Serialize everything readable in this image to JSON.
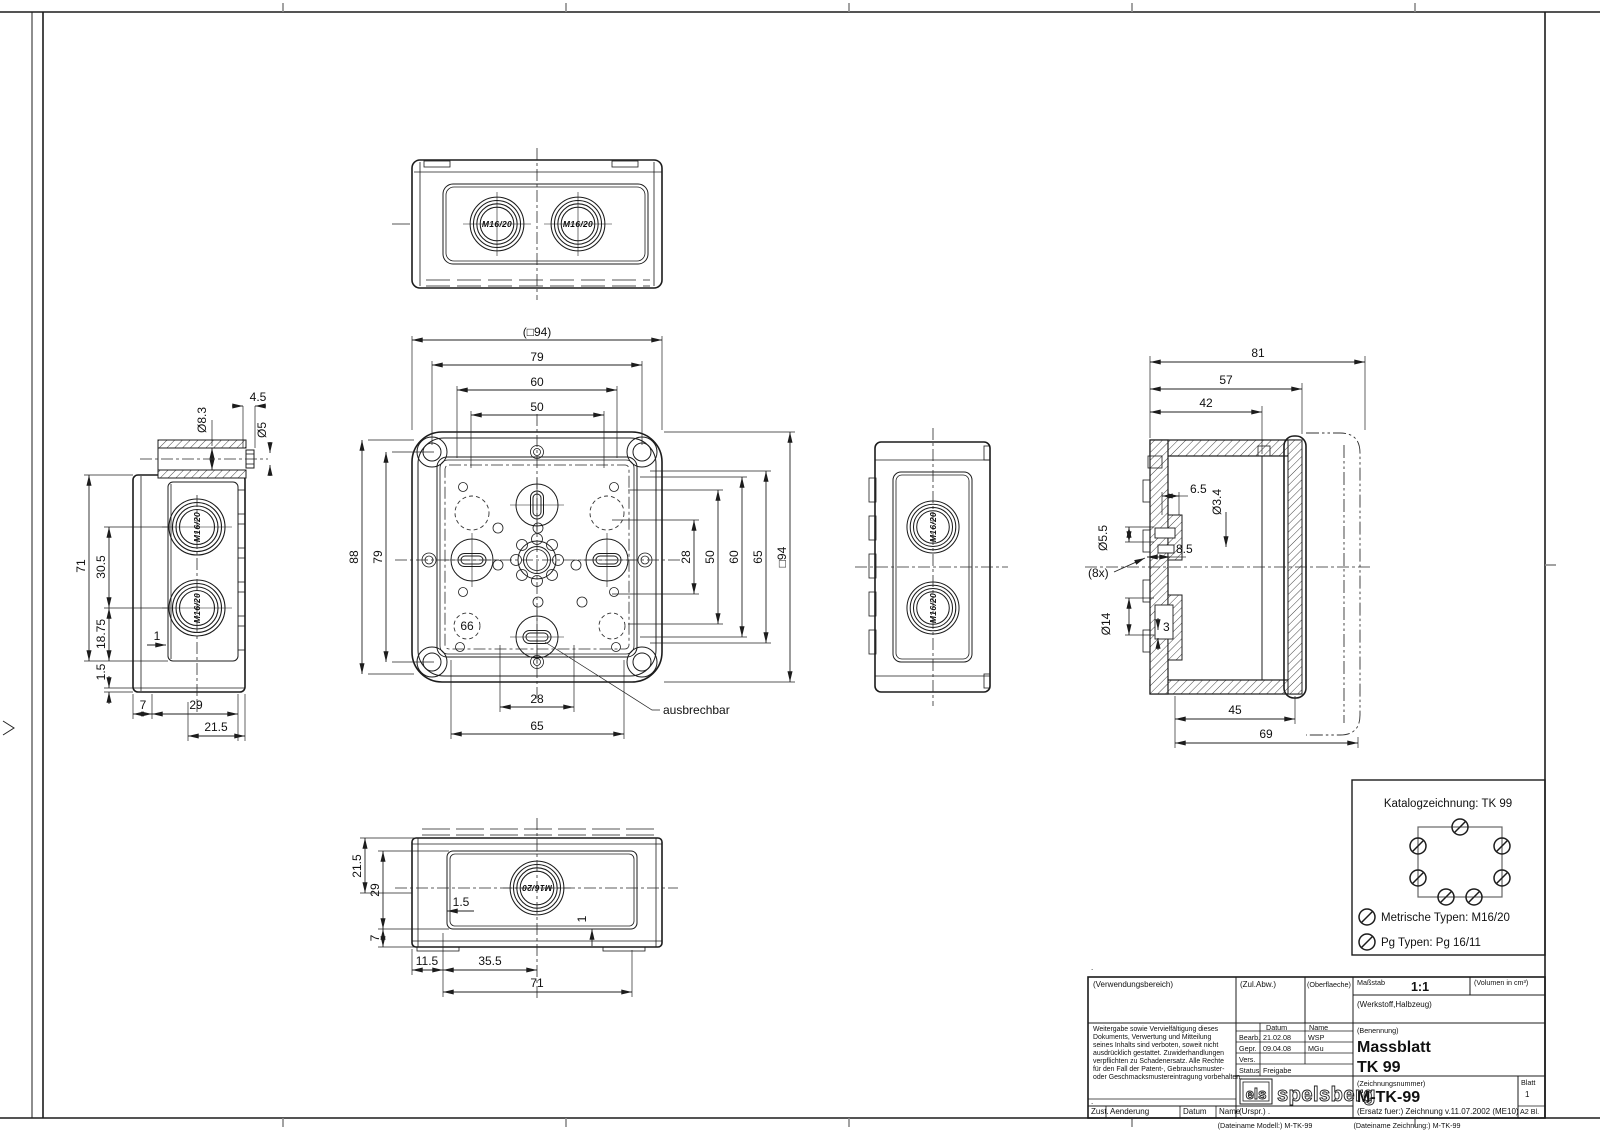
{
  "labels": {
    "m1620": "M16/20",
    "l66": "66",
    "ausbrechbar": "ausbrechbar"
  },
  "dims": {
    "main": {
      "sq94": "(□94)",
      "t79": "79",
      "t60": "60",
      "t50": "50",
      "l88": "88",
      "l79": "79",
      "r28": "28",
      "r50": "50",
      "r60": "60",
      "r65": "65",
      "r94": "□94",
      "b28": "28",
      "b65": "65"
    },
    "left": {
      "dia83": "Ø8.3",
      "d45": "4.5",
      "dia5": "Ø5",
      "d71": "71",
      "d305": "30.5",
      "d1875": "18.75",
      "d15": "1.5",
      "d1": "1",
      "d7": "7",
      "d29": "29",
      "d215": "21.5"
    },
    "section": {
      "d81": "81",
      "d57": "57",
      "d42": "42",
      "d65": "6.5",
      "dia34": "Ø3.4",
      "dia55": "Ø5.5",
      "d85": "8.5",
      "d8x": "(8x)",
      "dia14": "Ø14",
      "d3": "3",
      "d45": "45",
      "d69": "69"
    },
    "bottom": {
      "d215": "21.5",
      "d29": "29",
      "d7": "7",
      "d15": "1.5",
      "d1": "1",
      "d115": "11.5",
      "d355": "35.5",
      "d71": "71"
    }
  },
  "catalog": {
    "title": "Katalogzeichnung: TK 99",
    "metric": "Metrische Typen: M16/20",
    "pg": "Pg Typen: Pg 16/11"
  },
  "titleblock": {
    "verwendungsbereich": "(Verwendungsbereich)",
    "zul_abw": "(Zul.Abw.)",
    "oberflaeche": "(Oberflaeche)",
    "massstab_label": "Maßstab",
    "massstab": "1:1",
    "volumen": "(Volumen in cm³)",
    "werkstoff": "(Werkstoff,Halbzeug)",
    "copyright": [
      "Weitergabe sowie Vervielfältigung dieses",
      "Dokuments, Verwertung und Mitteilung",
      "seines Inhalts sind verboten, soweit nicht",
      "ausdrücklich gestattet. Zuwiderhandlungen",
      "verpflichten zu Schadenersatz. Alle Rechte",
      "für den Fall der Patent-, Gebrauchsmuster-",
      "oder Geschmacksmustereintragung vorbehalten."
    ],
    "datum_header": "Datum",
    "name_header": "Name",
    "bearb_label": "Bearb.",
    "bearb_datum": "21.02.08",
    "bearb_name": "WSP",
    "gepr_label": "Gepr.",
    "gepr_datum": "09.04.08",
    "gepr_name": "MGu",
    "vers_label": "Vers.",
    "status_label": "Status",
    "status_value": "Freigabe",
    "benennung_label": "(Benennung)",
    "benennung1": "Massblatt",
    "benennung2": "TK 99",
    "zeichnungsnummer_label": "(Zeichnungsnummer)",
    "zeichnungsnummer": "M-TK-99",
    "ersatz": "(Ersatz fuer:)  Zeichnung v.11.07.2002 (ME10)",
    "blatt_label": "Blatt",
    "blatt": "1",
    "format": "A2  Bl.",
    "zust": "Zust.",
    "aenderung": "Aenderung",
    "datum_col": "Datum",
    "name_col": "Name",
    "urspr": "(Urspr.) .",
    "logo_els": "els",
    "logo_name": "spelsberg"
  },
  "footer": {
    "model": "(Dateiname Modell:) M-TK-99",
    "drawing": "(Dateiname Zeichnung:) M-TK-99"
  },
  "misc": {
    "dot": "."
  }
}
